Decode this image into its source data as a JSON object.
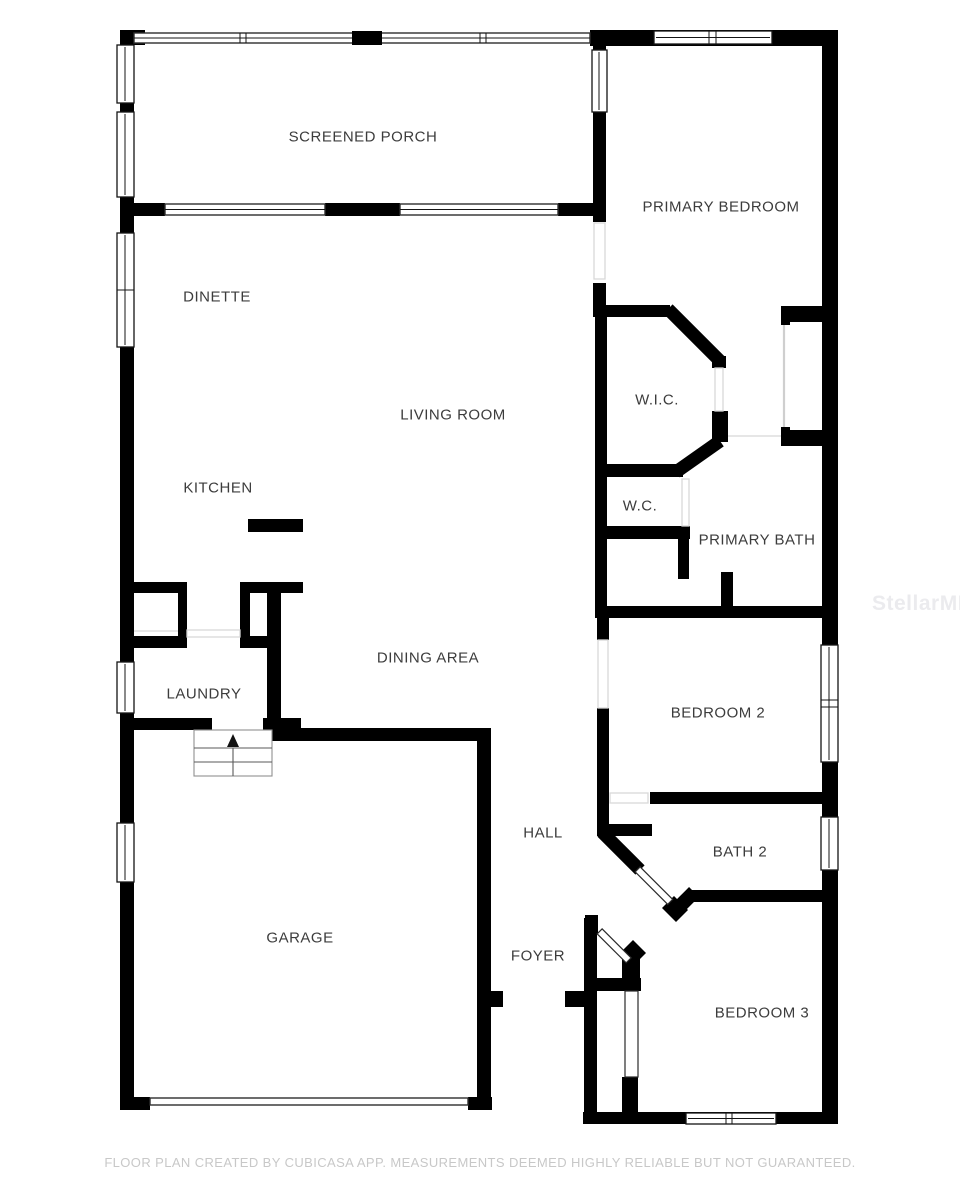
{
  "floor_plan": {
    "watermark": "StellarMLS",
    "footer_disclaimer": "FLOOR PLAN CREATED BY CUBICASA APP. MEASUREMENTS DEEMED HIGHLY RELIABLE BUT NOT GUARANTEED.",
    "rooms": {
      "screened_porch": "SCREENED PORCH",
      "primary_bedroom": "PRIMARY BEDROOM",
      "dinette": "DINETTE",
      "living_room": "LIVING ROOM",
      "wic": "W.I.C.",
      "kitchen": "KITCHEN",
      "wc": "W.C.",
      "primary_bath": "PRIMARY BATH",
      "dining_area": "DINING AREA",
      "laundry": "LAUNDRY",
      "bedroom_2": "BEDROOM 2",
      "hall": "HALL",
      "bath_2": "BATH 2",
      "garage": "GARAGE",
      "foyer": "FOYER",
      "bedroom_3": "BEDROOM 3"
    },
    "colors": {
      "wall": "#000000",
      "room_label": "#3c3c3c",
      "footer": "#c8c8c8",
      "watermark": "#ebebee",
      "door_swing": "#d8d8d8",
      "background": "#ffffff"
    },
    "icons": {
      "stairs_direction": "up-arrow"
    }
  }
}
